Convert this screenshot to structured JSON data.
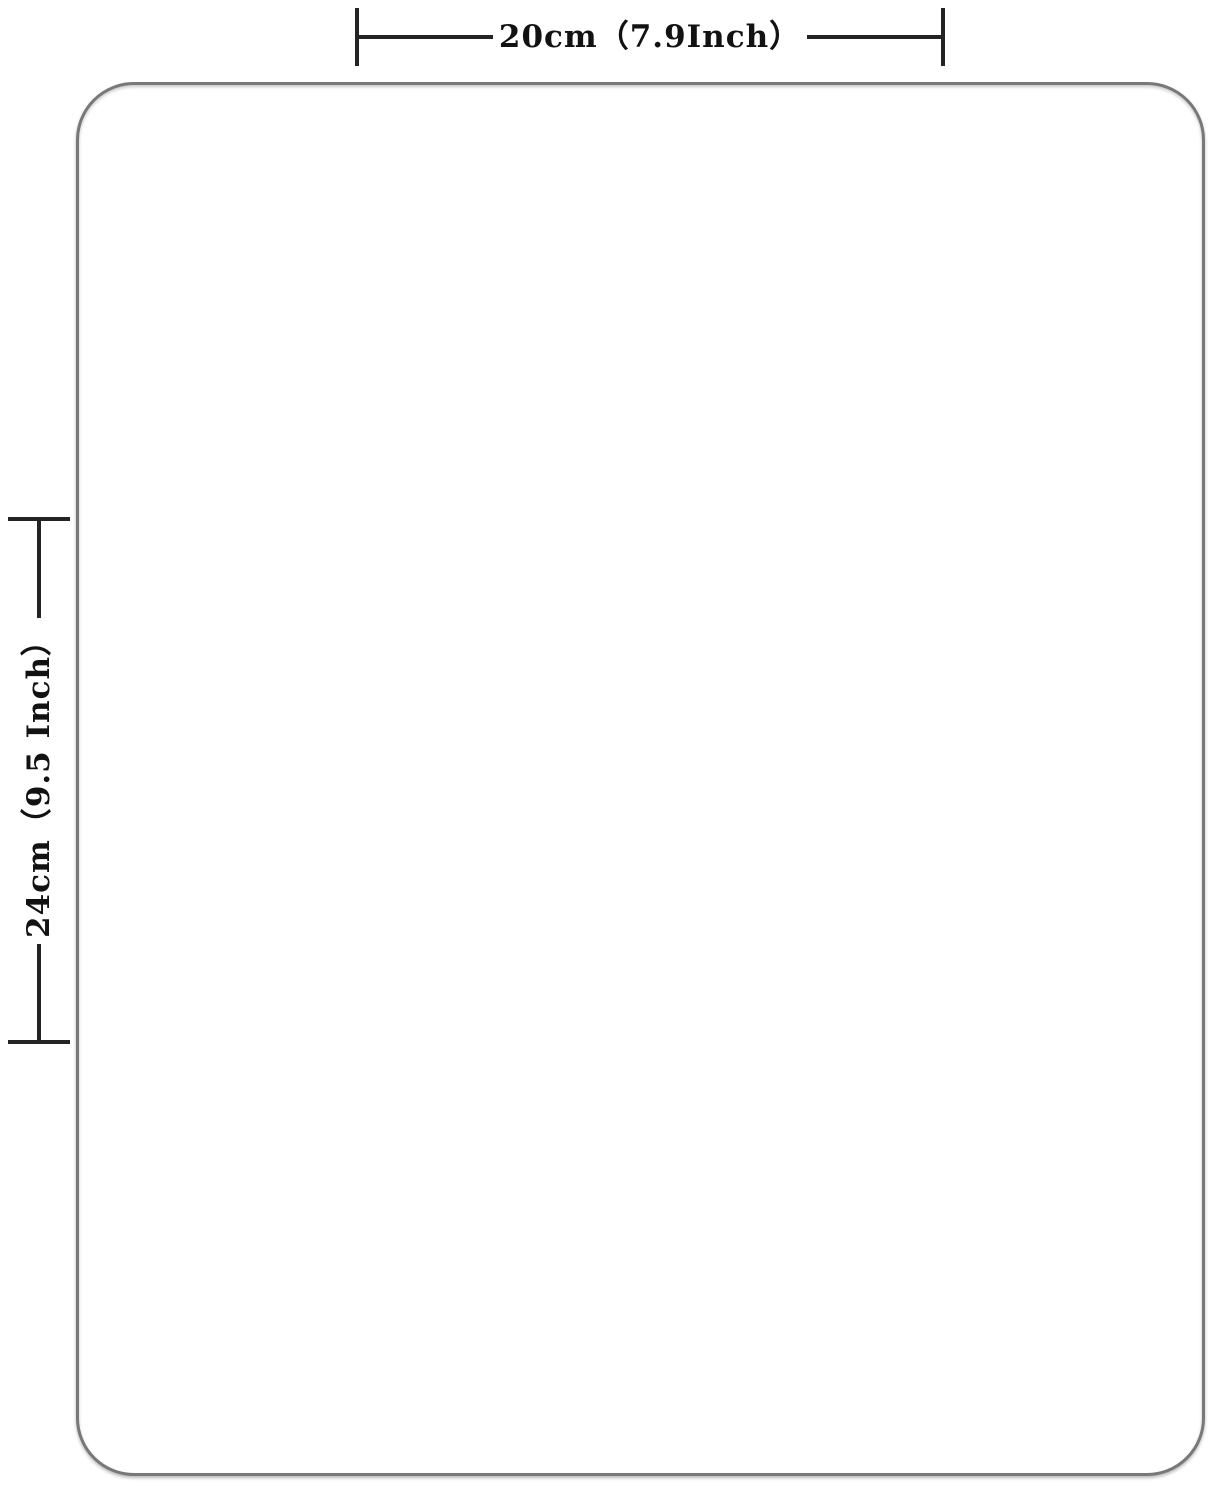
{
  "figure": {
    "type": "product-dimension-diagram",
    "width_label": "20cm（7.9Inch）",
    "height_label": "24cm（9.5 Inch）"
  },
  "colors": {
    "background": "#ffffff",
    "surface": "#ffffff",
    "surface_border": "#787878",
    "dimension_line": "#242424",
    "text": "#121212"
  }
}
